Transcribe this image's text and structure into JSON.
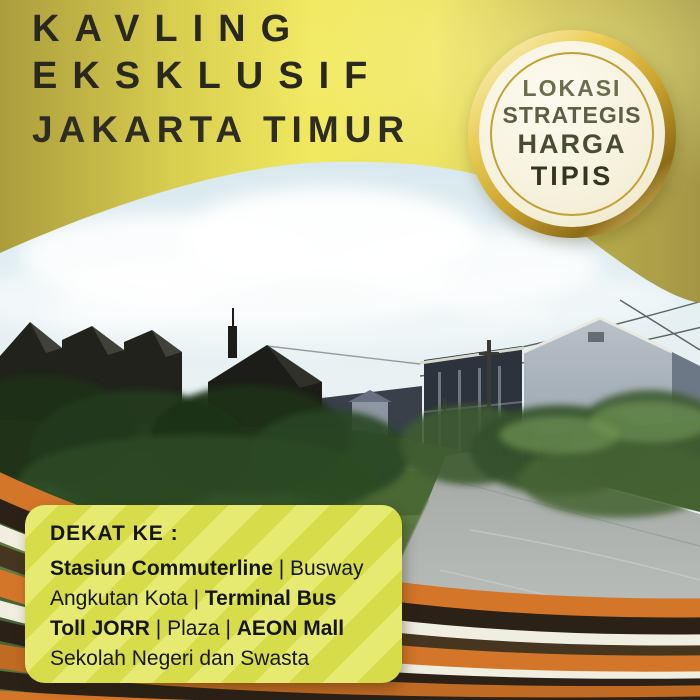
{
  "header": {
    "title_line1": "KAVLING",
    "title_line2": "EKSKLUSIF",
    "subtitle": "JAKARTA TIMUR"
  },
  "badge": {
    "line1": "LOKASI",
    "line2": "STRATEGIS",
    "line3": "HARGA",
    "line4": "TIPIS"
  },
  "panel": {
    "heading": "DEKAT KE :",
    "lines": [
      [
        {
          "t": "Stasiun Commuterline",
          "bold": true
        },
        {
          "t": " | Busway",
          "bold": false
        }
      ],
      [
        {
          "t": "Angkutan Kota | ",
          "bold": false
        },
        {
          "t": "Terminal Bus",
          "bold": true
        }
      ],
      [
        {
          "t": "Toll JORR",
          "bold": true
        },
        {
          "t": " | Plaza | ",
          "bold": false
        },
        {
          "t": "AEON Mall",
          "bold": true
        }
      ],
      [
        {
          "t": "Sekolah Negeri dan Swasta",
          "bold": false
        }
      ]
    ]
  },
  "photo": {
    "subject": "vacant land plot with grass field, concrete road and surrounding houses"
  },
  "colors": {
    "wave_gold_bright": "#f1e95f",
    "wave_gold_olive": "#a89b41",
    "badge_gold": "#cba32d",
    "badge_cream": "#f5f0da",
    "panel_bg": "#d7dc4a",
    "stripe_orange": "#d4762a",
    "stripe_dark": "#2b2117",
    "stripe_white": "#f0ede1",
    "stripe_olive": "#46361f",
    "title_text": "#28281f"
  }
}
